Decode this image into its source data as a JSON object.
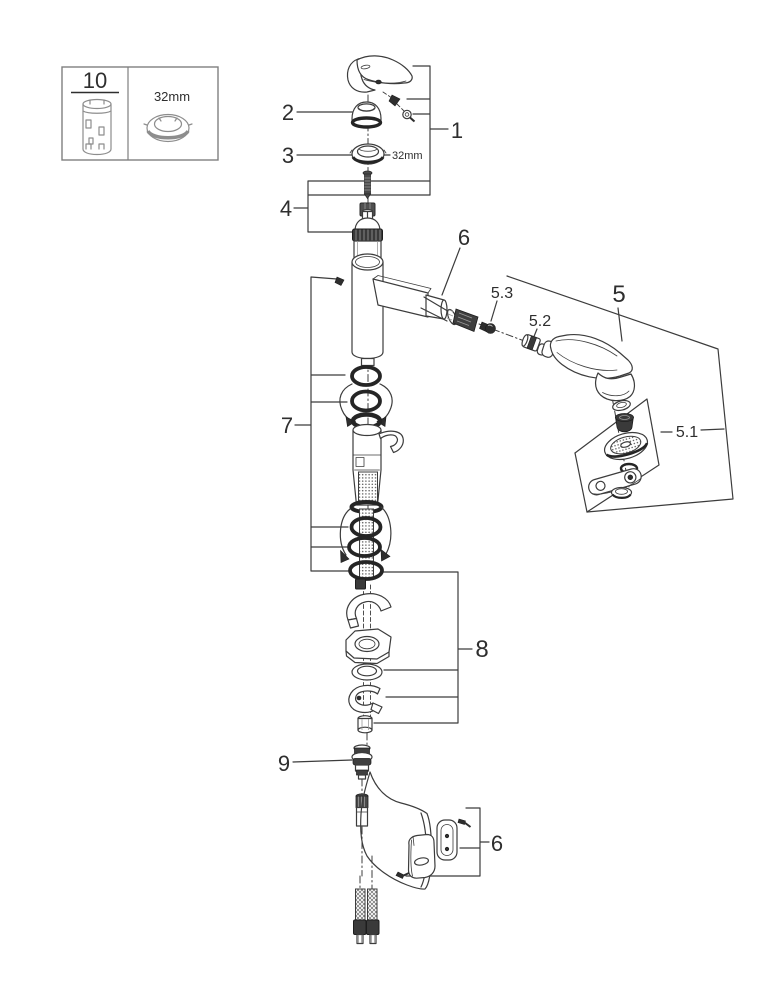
{
  "diagram": {
    "background": "#ffffff",
    "line_color": "#3c3c3c",
    "dark_fill": "#2e2e2e",
    "text_color": "#2e2e2e"
  },
  "legend": {
    "tool_label": "10",
    "wrench_size": "32mm"
  },
  "annotations": {
    "ring_nut_size": "32mm"
  },
  "callouts": {
    "c1": "1",
    "c2": "2",
    "c3": "3",
    "c4": "4",
    "c5": "5",
    "c5_1": "5.1",
    "c5_2": "5.2",
    "c5_3": "5.3",
    "c6_spout": "6",
    "c6_guide": "6",
    "c7": "7",
    "c8": "8",
    "c9": "9"
  }
}
